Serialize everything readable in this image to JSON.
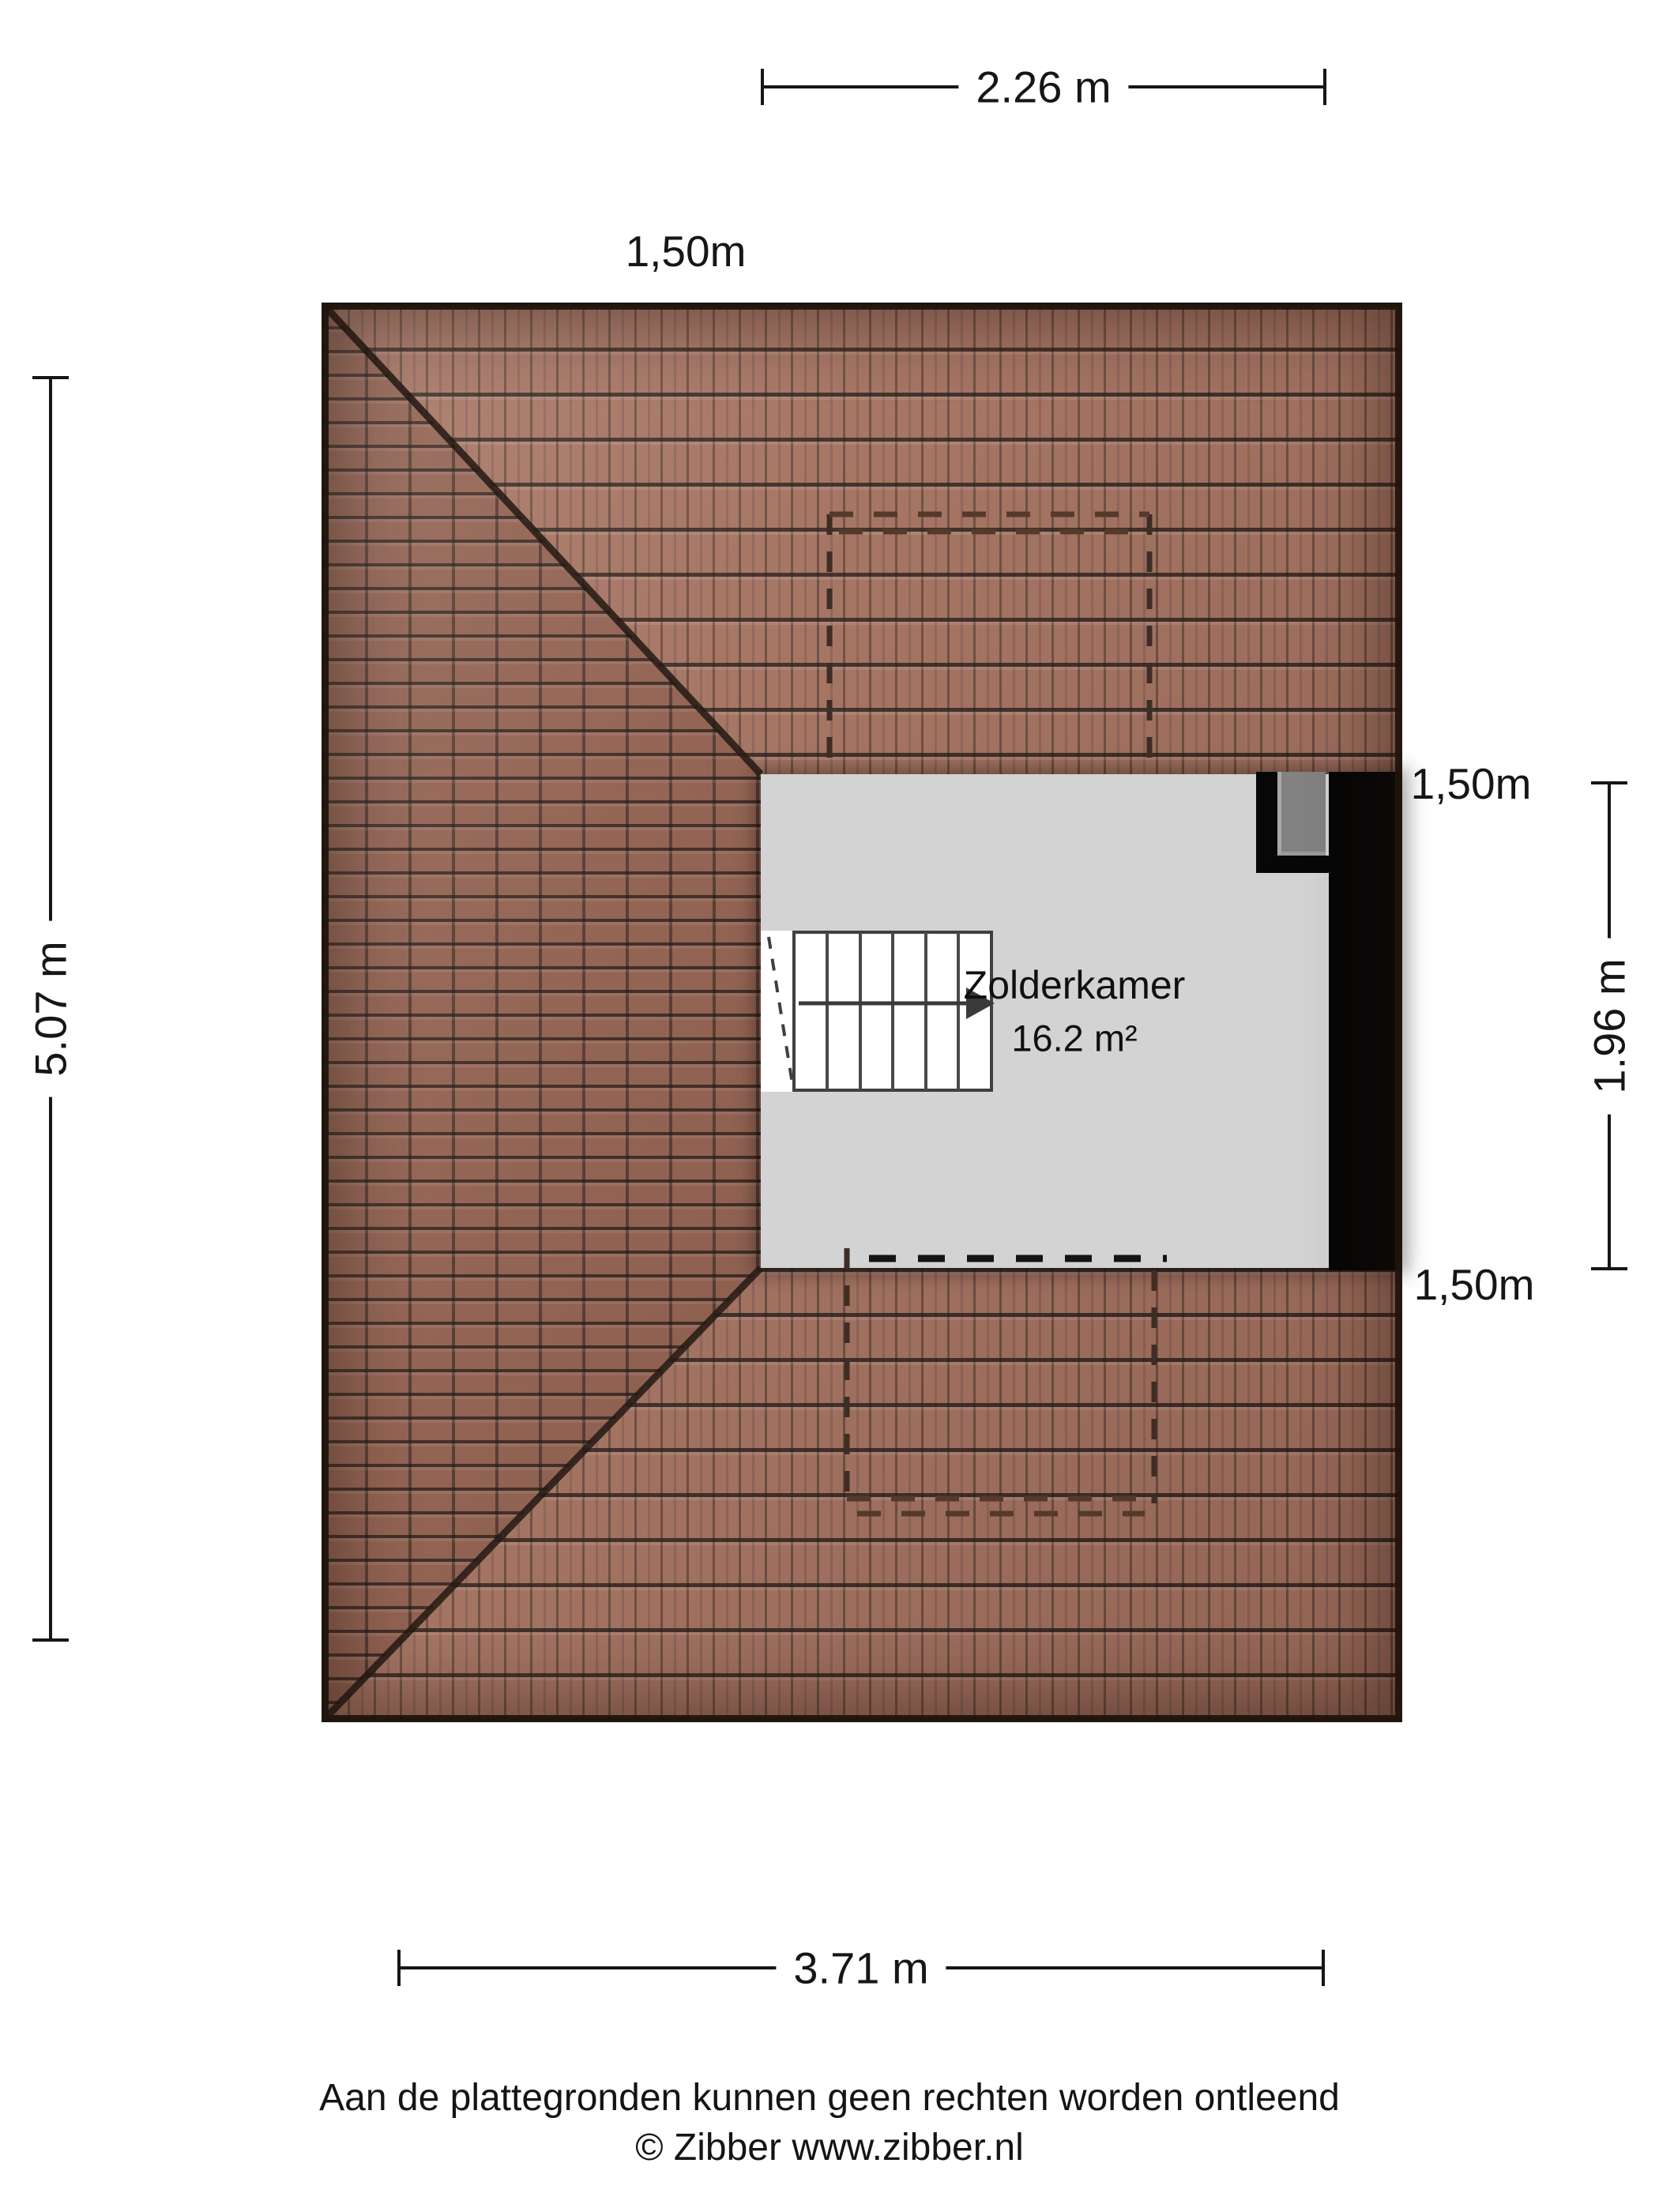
{
  "dimensions": {
    "top": "2.26 m",
    "bottom": "3.71 m",
    "left": "5.07 m",
    "right": "1.96 m"
  },
  "height_markers": {
    "top": "1,50m",
    "right_upper": "1,50m",
    "right_lower": "1,50m"
  },
  "room": {
    "name": "Zolderkamer",
    "area": "16.2 m²"
  },
  "footer": {
    "disclaimer": "Aan de plattegronden kunnen geen rechten worden ontleend",
    "copyright": "© Zibber www.zibber.nl"
  },
  "colors": {
    "roof_base": "#a26f5d",
    "roof_left_face": "#8d5c4b",
    "roof_edge": "#2b1c12",
    "room_fill": "#d3d3d3",
    "wall": "#070707",
    "chimney": "#828282",
    "dash_roof": "#3e2d24",
    "text": "#161616"
  }
}
